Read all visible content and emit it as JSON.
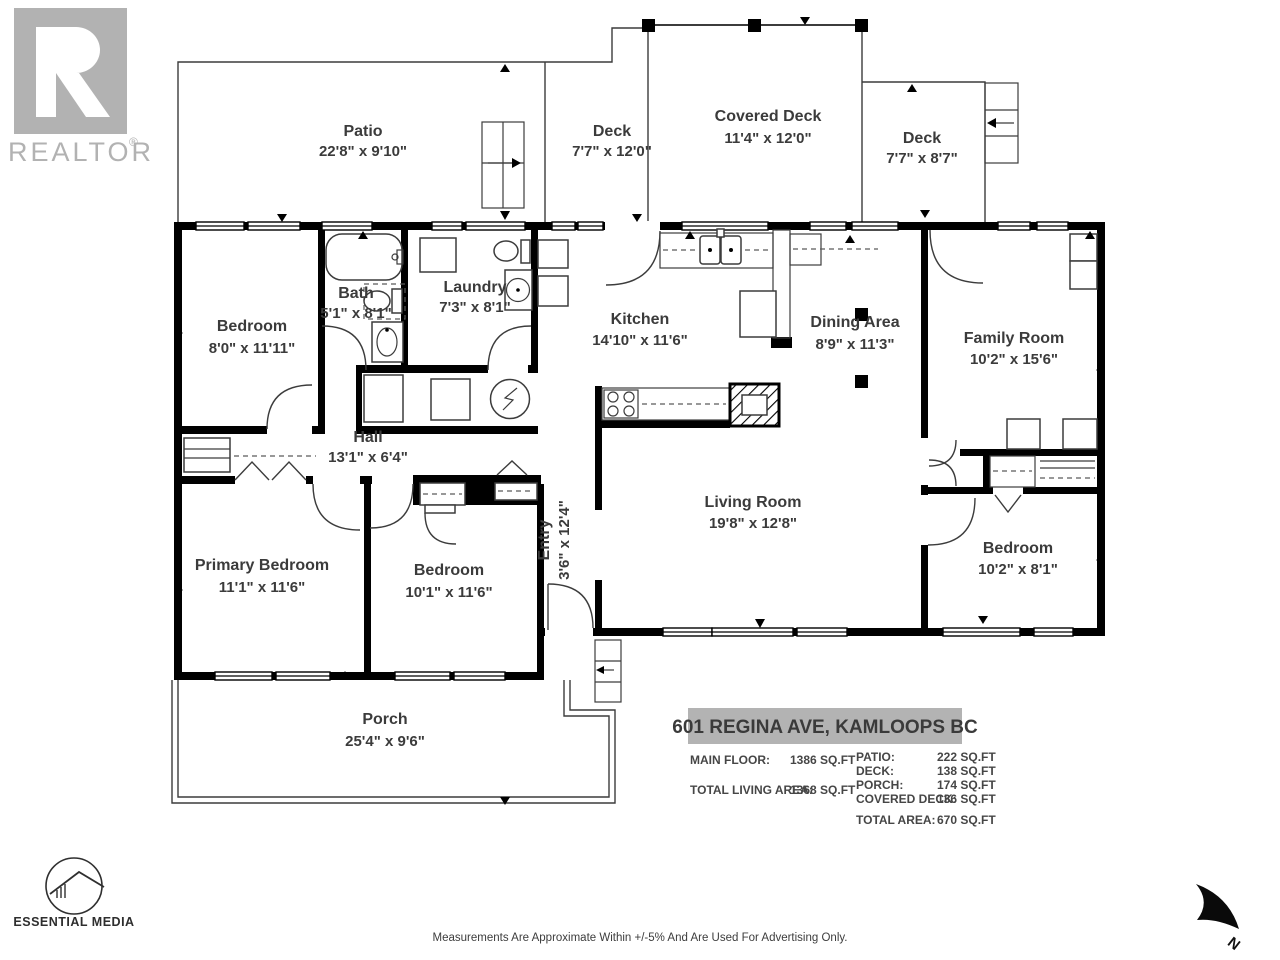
{
  "branding": {
    "realtor_logo_text": "REALTOR",
    "realtor_registered_mark": "®",
    "essential_media_label": "ESSENTIAL MEDIA"
  },
  "compass": {
    "north_label": "N"
  },
  "address_banner": "601 REGINA AVE, KAMLOOPS BC",
  "rooms": [
    {
      "name": "Patio",
      "dims": "22'8\" x 9'10\""
    },
    {
      "name": "Deck",
      "dims": "7'7\" x 12'0\""
    },
    {
      "name": "Covered Deck",
      "dims": "11'4\" x 12'0\""
    },
    {
      "name": "Deck",
      "dims": "7'7\" x 8'7\""
    },
    {
      "name": "Bedroom",
      "dims": "8'0\" x 11'11\""
    },
    {
      "name": "Bath",
      "dims": "5'1\" x 8'1\""
    },
    {
      "name": "Laundry",
      "dims": "7'3\" x 8'1\""
    },
    {
      "name": "Kitchen",
      "dims": "14'10\" x 11'6\""
    },
    {
      "name": "Dining Area",
      "dims": "8'9\" x 11'3\""
    },
    {
      "name": "Family Room",
      "dims": "10'2\" x 15'6\""
    },
    {
      "name": "Hall",
      "dims": "13'1\" x 6'4\""
    },
    {
      "name": "Entry",
      "dims": "3'6\" x 12'4\""
    },
    {
      "name": "Living Room",
      "dims": "19'8\" x 12'8\""
    },
    {
      "name": "Primary Bedroom",
      "dims": "11'1\" x 11'6\""
    },
    {
      "name": "Bedroom",
      "dims": "10'1\" x 11'6\""
    },
    {
      "name": "Bedroom",
      "dims": "10'2\" x 8'1\""
    },
    {
      "name": "Porch",
      "dims": "25'4\" x 9'6\""
    }
  ],
  "areas": {
    "left": [
      {
        "label": "MAIN FLOOR:",
        "value": "1386 SQ.FT"
      },
      {
        "label": "TOTAL LIVING AREA:",
        "value": "1368 SQ.FT"
      }
    ],
    "right": [
      {
        "label": "PATIO:",
        "value": "222 SQ.FT"
      },
      {
        "label": "DECK:",
        "value": "138 SQ.FT"
      },
      {
        "label": "PORCH:",
        "value": "174 SQ.FT"
      },
      {
        "label": "COVERED DECK:",
        "value": "136 SQ.FT"
      }
    ],
    "total": {
      "label": "TOTAL AREA:",
      "value": "670 SQ.FT"
    }
  },
  "disclaimer": "Measurements Are Approximate Within +/-5% And Are Used For Advertising Only.",
  "colors": {
    "logo_gray": "#b2b2b2",
    "banner_gray": "#b3b3b3",
    "wall_black": "#000000",
    "text_dark": "#3b3b3b"
  }
}
